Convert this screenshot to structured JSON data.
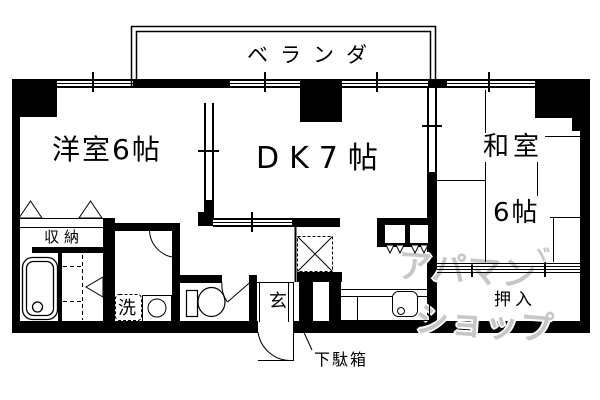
{
  "labels": {
    "veranda": "ベランダ",
    "western_room": "洋室6帖",
    "dining_kitchen": "DK7帖",
    "japanese_room": "和室",
    "japanese_room_size": "6帖",
    "storage": "収納",
    "laundry": "洗",
    "entrance": "玄",
    "futon_closet": "押入",
    "shoe_cabinet": "下駄箱"
  },
  "watermark": {
    "line1": "アパマン",
    "mark": "ヾ",
    "line2": "ショップ",
    "color": "#c7c7c7"
  },
  "colors": {
    "line": "#000000",
    "background": "#ffffff"
  }
}
